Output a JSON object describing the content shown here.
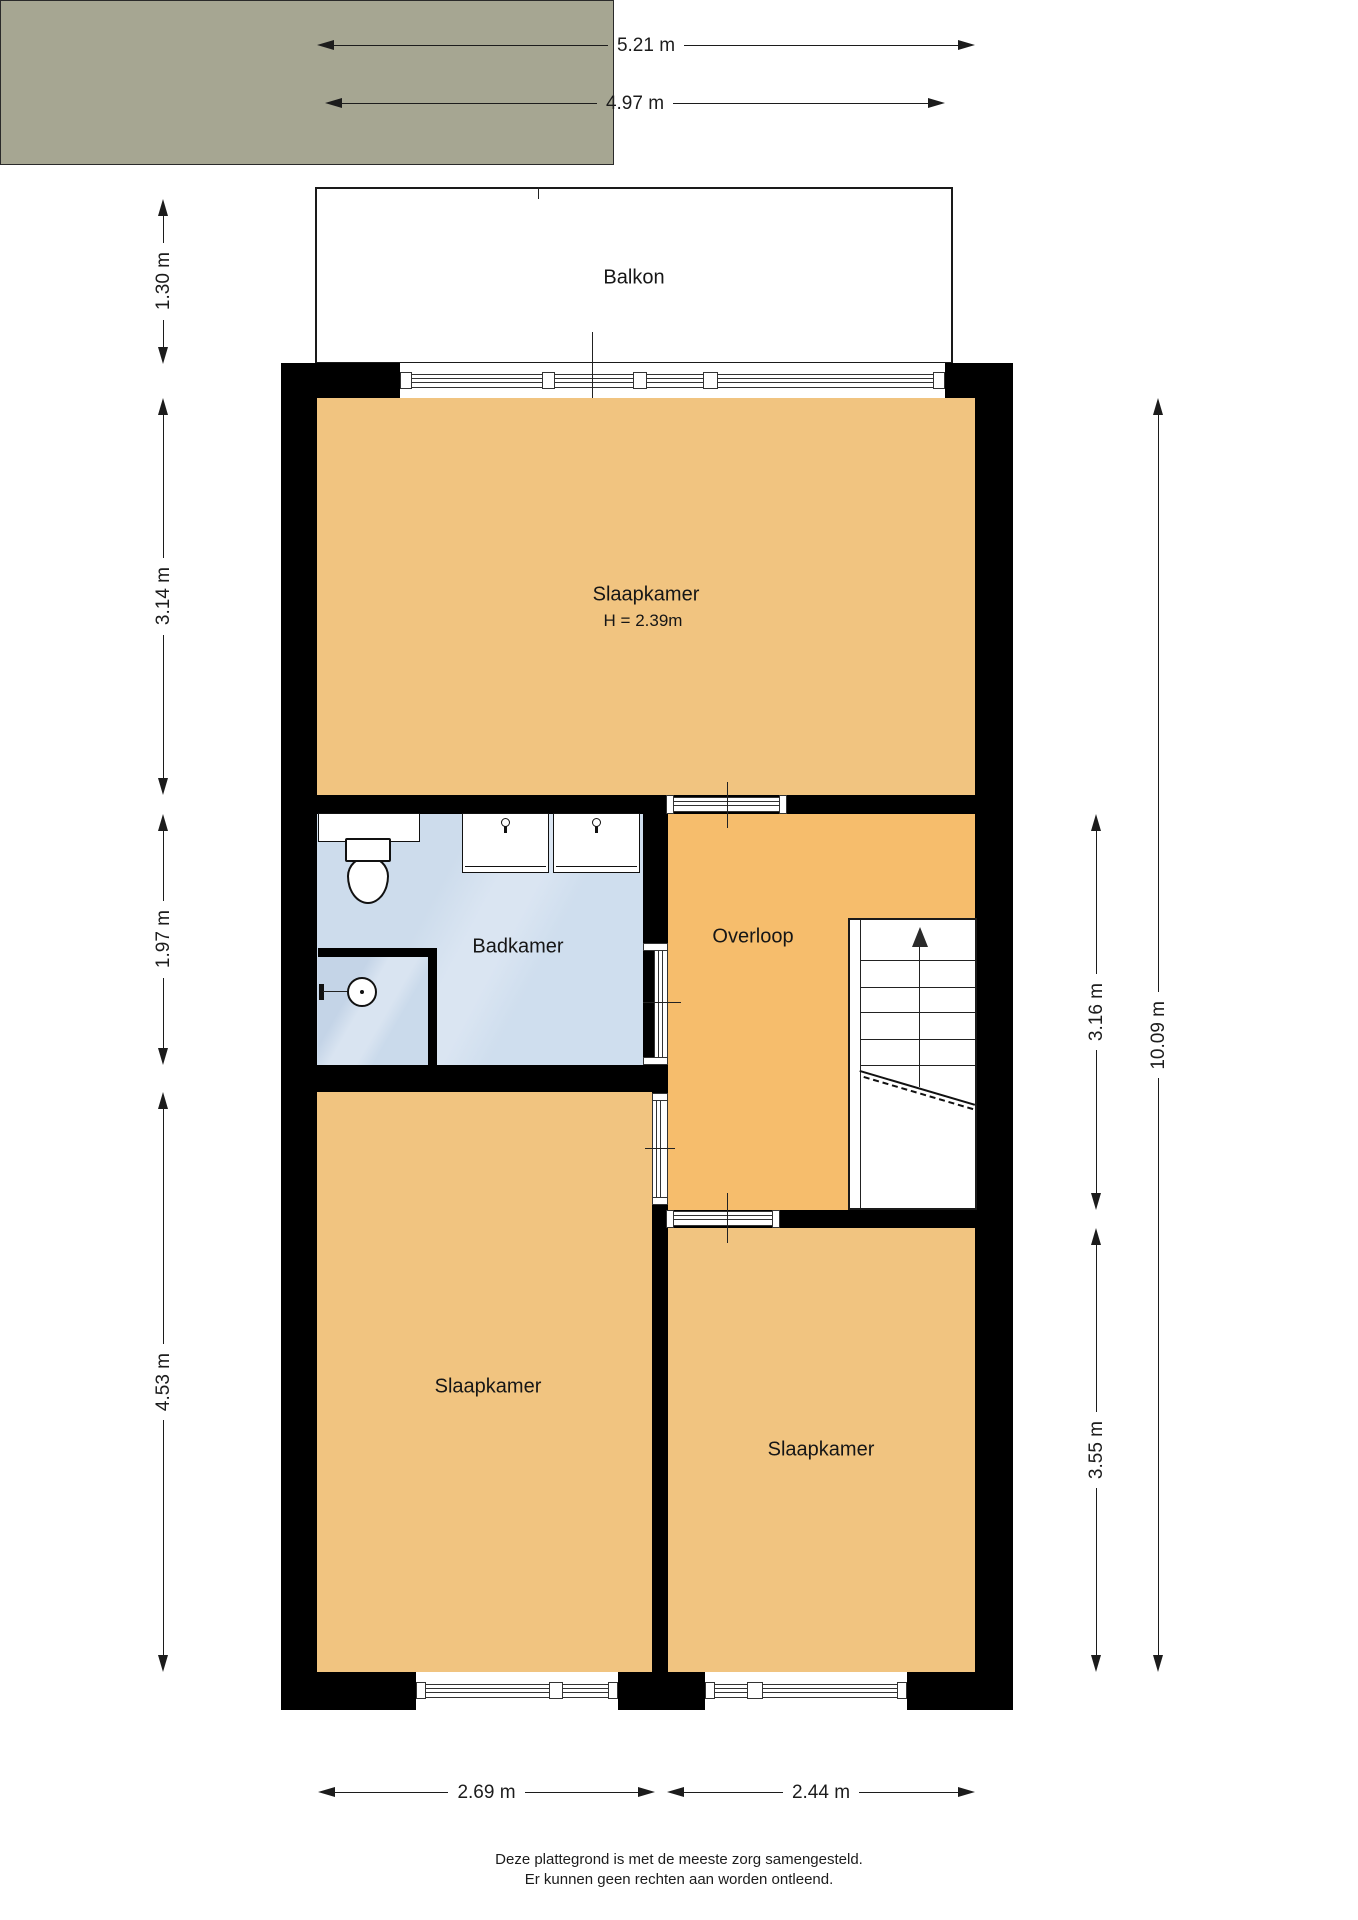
{
  "rooms": {
    "balkon": {
      "label": "Balkon"
    },
    "slaapkamer_boven": {
      "label": "Slaapkamer",
      "height_note": "H = 2.39m"
    },
    "badkamer": {
      "label": "Badkamer"
    },
    "overloop": {
      "label": "Overloop"
    },
    "slaapkamer_linksonder": {
      "label": "Slaapkamer"
    },
    "slaapkamer_rechtsonder": {
      "label": "Slaapkamer"
    }
  },
  "dimensions": {
    "breedte_totaal": "5.21 m",
    "breedte_balkon": "4.97 m",
    "diepte_balkon": "1.30 m",
    "hoogte_slaapkamer_boven": "3.14 m",
    "hoogte_badkamer": "1.97 m",
    "hoogte_slaapkamer_links": "4.53 m",
    "hoogte_overloop": "3.16 m",
    "hoogte_slaapkamer_rechts": "3.55 m",
    "hoogte_totaal": "10.09 m",
    "breedte_slaapkamer_links": "2.69 m",
    "breedte_slaapkamer_rechts": "2.44 m"
  },
  "footer": {
    "line1": "Deze plattegrond is met de meeste zorg samengesteld.",
    "line2": "Er kunnen geen rechten aan worden ontleend."
  },
  "colors": {
    "bedroom": "#f1c480",
    "hall": "#f6bd6c",
    "bathroom": "#cfdeee",
    "balcony": "#a6a692",
    "wall": "#000000"
  }
}
